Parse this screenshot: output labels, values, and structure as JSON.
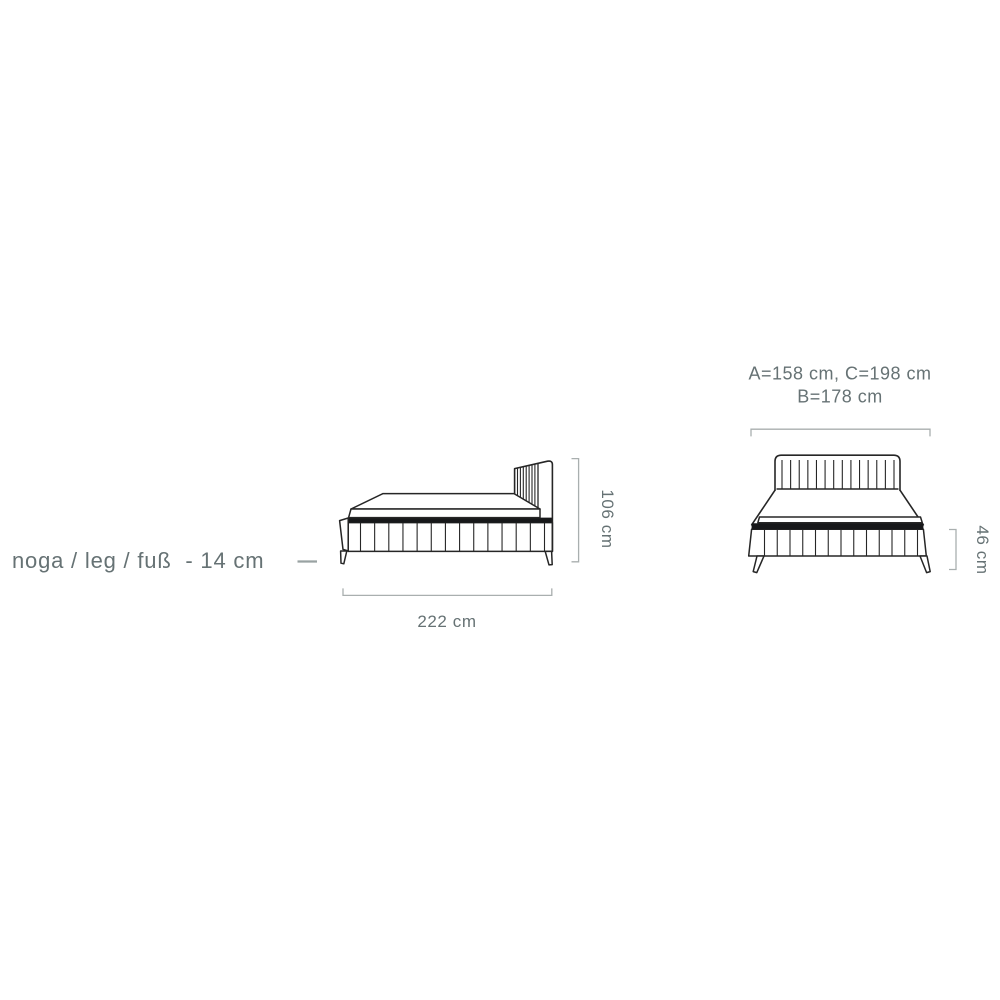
{
  "colors": {
    "line": "#262626",
    "band": "#17181a",
    "dim": "#a9afaf",
    "text": "#667274",
    "bg": "#ffffff"
  },
  "labels": {
    "leg_note": "noga / leg / fuß  - 14 cm",
    "side_width": "222 cm",
    "side_height": "106 cm",
    "front_widths_line1": "A=158 cm, C=198 cm",
    "front_widths_line2": "B=178 cm",
    "front_base_height": "46 cm"
  }
}
